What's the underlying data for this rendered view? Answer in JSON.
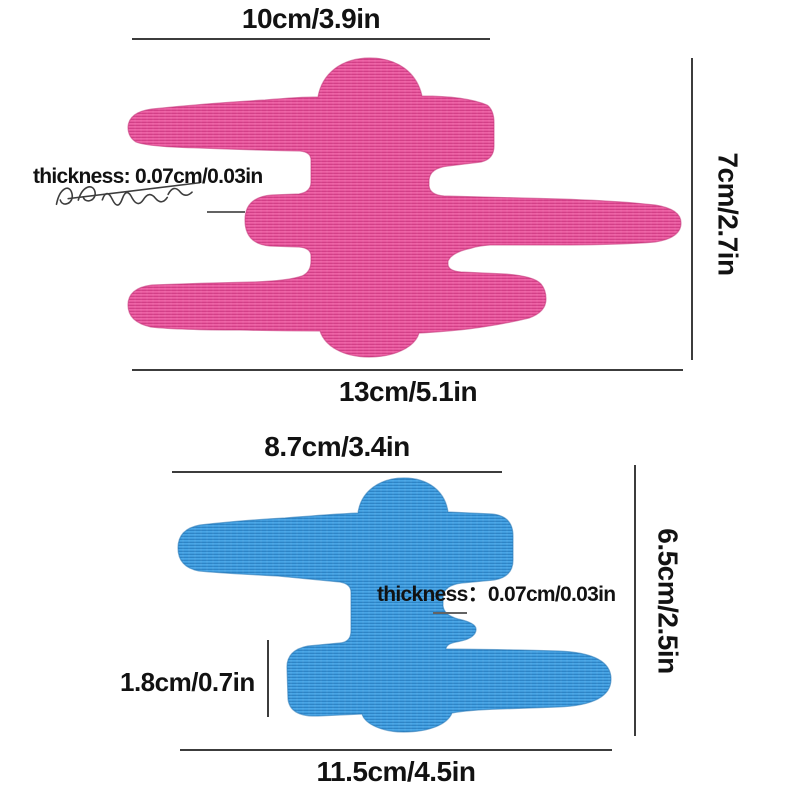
{
  "figure": {
    "background": "#ffffff",
    "line_color": "#3c3c3c",
    "pointer_color": "#636363",
    "text_color": "#121212"
  },
  "pink_tape": {
    "name": "kinesiology-tape-pink",
    "color_light": "#ee61a5",
    "color_dark": "#d23f87",
    "edge_color": "#c23578",
    "labels": {
      "top_width": "10cm/3.9in",
      "right_height": "7cm/2.7in",
      "bottom_width": "13cm/5.1in",
      "thickness": "thickness: 0.07cm/0.03in"
    }
  },
  "blue_tape": {
    "name": "kinesiology-tape-blue",
    "color_light": "#48a5e6",
    "color_dark": "#2d84c6",
    "edge_color": "#2676b4",
    "labels": {
      "top_width": "8.7cm/3.4in",
      "right_height": "6.5cm/2.5in",
      "bottom_width": "11.5cm/4.5in",
      "thickness": "thickness：0.07cm/0.03in",
      "segment_height": "1.8cm/0.7in"
    }
  }
}
